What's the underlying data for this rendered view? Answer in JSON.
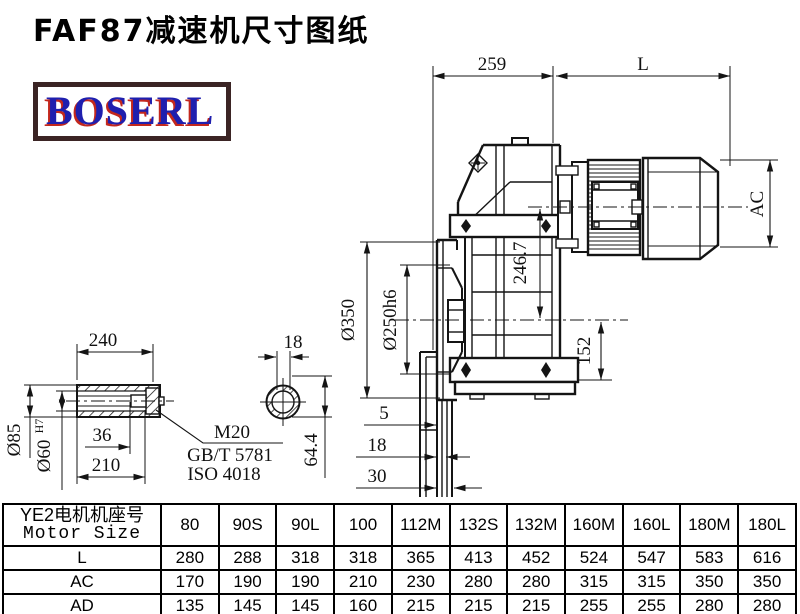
{
  "page": {
    "title": "FAF87减速机尺寸图纸"
  },
  "logo": {
    "text": "BOSERL"
  },
  "drawing": {
    "dims": {
      "top_width": "259",
      "motor_length": "L",
      "motor_diameter": "AC",
      "flange_diameter": "Ø350",
      "spigot_diameter": "Ø250h6",
      "center_height": "246.7",
      "center_to_base": "152",
      "flange_step_1": "5",
      "flange_step_2": "18",
      "flange_step_3": "30",
      "shaft_length": "240",
      "shaft_outer_diameter": "Ø85",
      "bore_diameter": "Ø60",
      "bore_tolerance": "H7",
      "bolt_depth": "36",
      "bore_depth": "210",
      "thread_label": "M20",
      "standard_1": "GB/T 5781",
      "standard_2": "ISO 4018",
      "key_width": "18",
      "key_height": "64.4"
    }
  },
  "table": {
    "header_cn": "YE2电机机座号",
    "header_en": "Motor Size",
    "frame_sizes": [
      "80",
      "90S",
      "90L",
      "100",
      "112M",
      "132S",
      "132M",
      "160M",
      "160L",
      "180M",
      "180L"
    ],
    "rows": [
      {
        "label": "L",
        "values": [
          "280",
          "288",
          "318",
          "318",
          "365",
          "413",
          "452",
          "524",
          "547",
          "583",
          "616"
        ]
      },
      {
        "label": "AC",
        "values": [
          "170",
          "190",
          "190",
          "210",
          "230",
          "280",
          "280",
          "315",
          "315",
          "350",
          "350"
        ]
      },
      {
        "label": "AD",
        "values": [
          "135",
          "145",
          "145",
          "160",
          "215",
          "215",
          "215",
          "255",
          "255",
          "280",
          "280"
        ]
      }
    ]
  }
}
